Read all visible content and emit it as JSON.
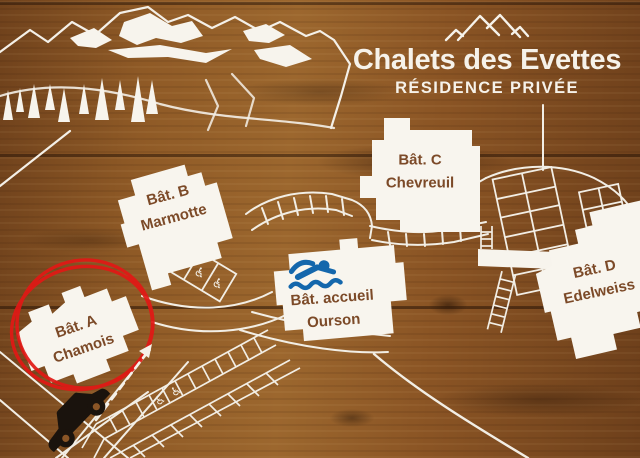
{
  "sign": {
    "title": "Chalets des Evettes",
    "subtitle": "RÉSIDENCE PRIVÉE"
  },
  "buildings": [
    {
      "id": "A",
      "line1": "Bât. A",
      "line2": "Chamois",
      "highlighted": true
    },
    {
      "id": "B",
      "line1": "Bât. B",
      "line2": "Marmotte",
      "highlighted": false
    },
    {
      "id": "C",
      "line1": "Bât. C",
      "line2": "Chevreuil",
      "highlighted": false
    },
    {
      "id": "accueil",
      "line1": "Bât. accueil",
      "line2": "Ourson",
      "amenity": "swimming-pool",
      "highlighted": false
    },
    {
      "id": "D",
      "line1": "Bât. D",
      "line2": "Edelweiss",
      "highlighted": false
    }
  ],
  "glyphs": {
    "wheelchair": "♿"
  },
  "markers": {
    "car": "black car at entrance road",
    "route_arrow": "white dashed arrow toward Bât. A",
    "highlight": "hand-drawn red circle around Bât. A Chamois"
  },
  "colors": {
    "wood": "#875426",
    "paint_white": "#f6f2ea",
    "label_brown": "#7c4a28",
    "pool_blue": "#1467ac",
    "highlight_red": "#e21815",
    "car_black": "#1a130d"
  }
}
